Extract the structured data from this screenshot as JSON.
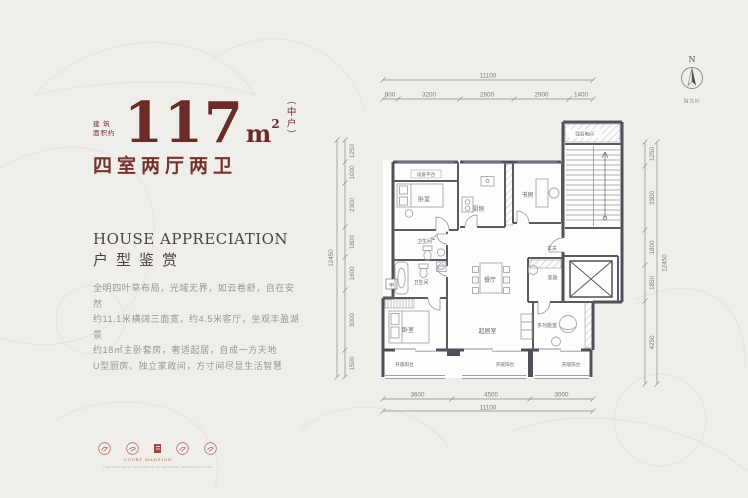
{
  "hero": {
    "prefix_line1": "建 筑",
    "prefix_line2": "面积约",
    "area_number": "117",
    "area_unit": "m",
    "area_sup": "2",
    "area_note": "（中户）",
    "layout_text": "四室两厅两卫"
  },
  "appreciation": {
    "title_en": "HOUSE APPRECIATION",
    "title_cn": "户型鉴赏",
    "lines": [
      "全明四叶草布局，光域无界，如云卷舒，自在安然",
      "约11.1米横阔三面宽，约4.5米客厅，坐观丰盈湖景",
      "约18㎡主卧套房，奢适起居，自成一方天地",
      "U型厨房、独立家政间，方寸间尽显生活智慧"
    ]
  },
  "seals": {
    "caption_en": "COURT MANSION",
    "caption_sub": "THE AESTHETIC RESIDENCE OF ORIENTAL HUMANISTIC LIFE"
  },
  "compass": {
    "letter": "N",
    "label": "指北针"
  },
  "plan": {
    "rooms": {
      "equip": "设备平台",
      "bedroom1": "卧室",
      "bath1": "卫生间",
      "bath2": "卫生间",
      "duct": "甲",
      "bedroom2": "卧室",
      "kitchen": "厨房",
      "study": "书房",
      "elec": "强弱电间",
      "foyer": "玄关",
      "dining": "餐厅",
      "house": "家政",
      "living": "起居室",
      "multi": "多功能室",
      "balcony1": "开敞阳台",
      "balcony2": "开敞阳台",
      "balcony3": "开敞阳台"
    },
    "dims": {
      "top_total": "11100",
      "top": [
        "800",
        "3200",
        "2800",
        "2900",
        "1400"
      ],
      "left_total": "12450",
      "left": [
        "1250",
        "1000",
        "2300",
        "1800",
        "1600",
        "3000",
        "1500"
      ],
      "right": [
        "1250",
        "3300",
        "1800",
        "1850",
        "4250"
      ],
      "right_total": "12450",
      "bottom": [
        "3600",
        "4500",
        "3000"
      ],
      "bottom_total": "11100"
    }
  },
  "colors": {
    "accent_maroon": "#6b2b27",
    "seal_red": "#a5463c"
  }
}
